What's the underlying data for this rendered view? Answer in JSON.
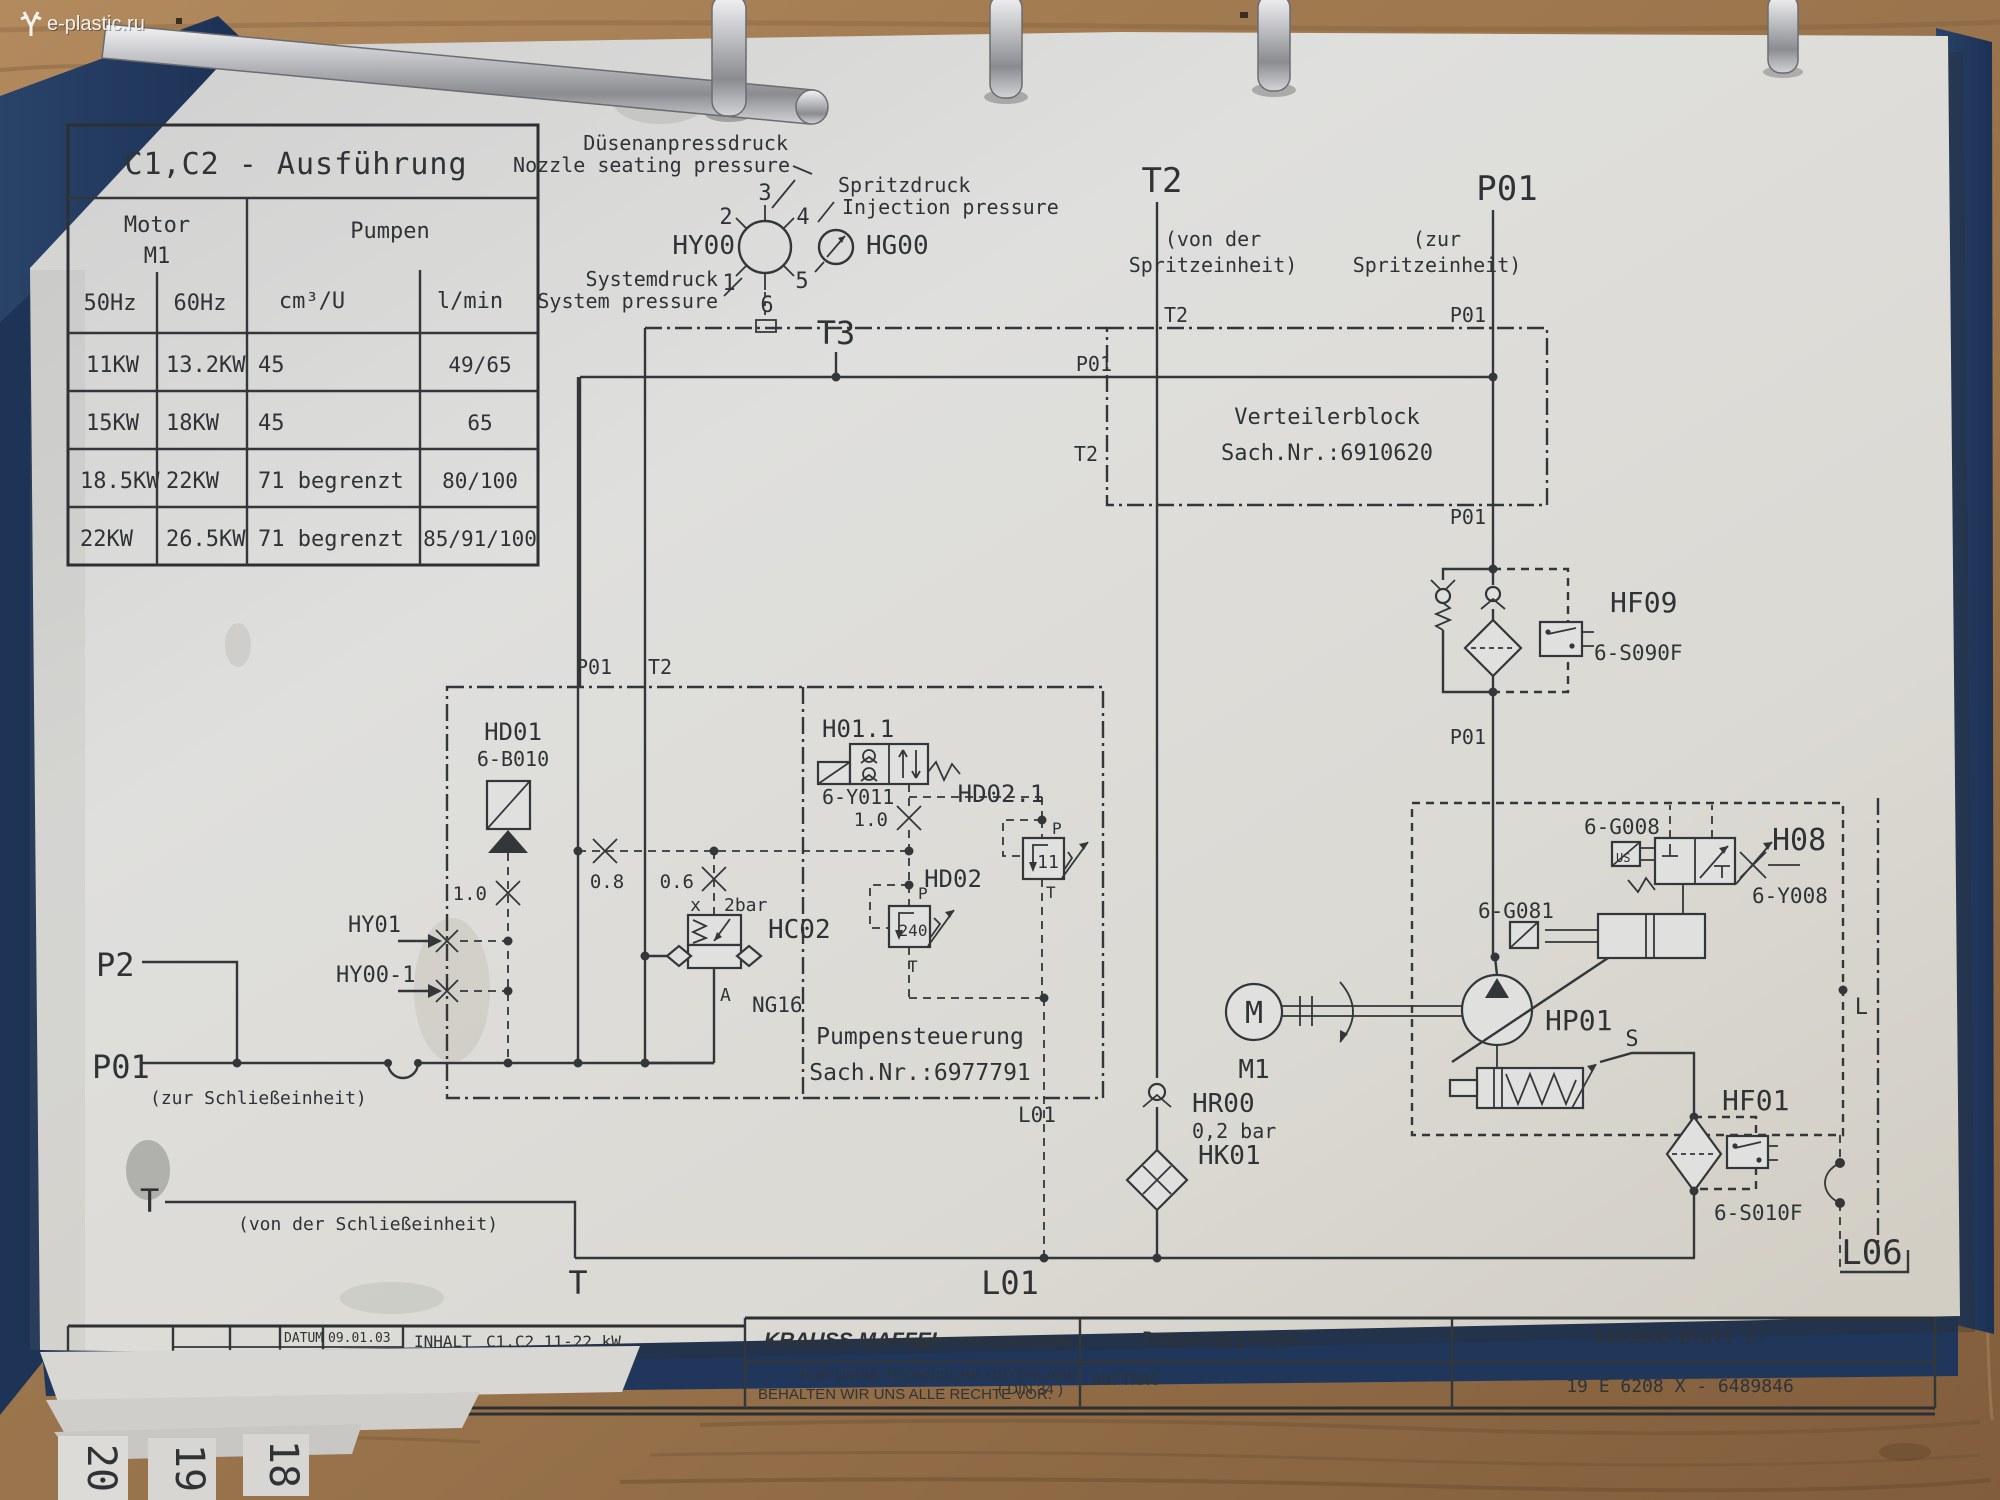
{
  "watermark": "e-plastic.ru",
  "spec_table": {
    "title": "C1,C2 - Ausführung",
    "motor": "Motor",
    "motor_sub": "M1",
    "pumpen": "Pumpen",
    "hz50": "50Hz",
    "hz60": "60Hz",
    "cm3u": "cm³/U",
    "lmin": "l/min",
    "rows": [
      {
        "kw50": "11KW",
        "kw60": "13.2KW",
        "cm3": "45",
        "lmin": "49/65"
      },
      {
        "kw50": "15KW",
        "kw60": "18KW",
        "cm3": "45",
        "lmin": "65"
      },
      {
        "kw50": "18.5KW",
        "kw60": "22KW",
        "cm3": "71 begrenzt",
        "lmin": "80/100"
      },
      {
        "kw50": "22KW",
        "kw60": "26.5KW",
        "cm3": "71 begrenzt",
        "lmin": "85/91/100"
      }
    ]
  },
  "gauge": {
    "duesen_de": "Düsenanpressdruck",
    "duesen_en": "Nozzle seating pressure",
    "spritz_de": "Spritzdruck",
    "spritz_en": "Injection pressure",
    "system_de": "Systemdruck",
    "system_en": "System pressure",
    "hy00": "HY00",
    "hg00": "HG00",
    "t3": "T3",
    "pos1": "1",
    "pos2": "2",
    "pos3": "3",
    "pos4": "4",
    "pos5": "5",
    "pos6": "6"
  },
  "ports": {
    "t2": "T2",
    "von_der": "(von der",
    "spritzeinheit": "Spritzeinheit)",
    "p01": "P01",
    "zur": "(zur",
    "t2_s1": "T2",
    "p01_s0": "P01",
    "p01_s1": "P01",
    "t2_s2": "T2",
    "p01_s2": "P01",
    "p01_s3": "P01",
    "box_p01": "P01",
    "box_t2": "T2",
    "p2": "P2",
    "p01_left": "P01",
    "zur_schliesseinheit": "(zur Schließeinheit)",
    "t_left": "T",
    "von_der_schliesseinheit": "(von der Schließeinheit)",
    "t_bottom": "T",
    "l01_big": "L01",
    "l01_small": "L01",
    "l06": "L06",
    "l": "L",
    "s": "S"
  },
  "verteilerblock": {
    "name": "Verteilerblock",
    "sachnr": "Sach.Nr.:6910620"
  },
  "pumpensteuerung": {
    "name": "Pumpensteuerung",
    "sachnr": "Sach.Nr.:6977791"
  },
  "components": {
    "hd01": "HD01",
    "hd01_code": "6-B010",
    "or_a": "1.0",
    "or_b": "0.8",
    "or_c": "0.6",
    "or_d": "1.0",
    "hy01": "HY01",
    "hy00_1": "HY00-1",
    "hc02": "HC02",
    "hc02_x": "x",
    "hc02_p": "2bar",
    "hc02_a": "A",
    "hc02_ng": "NG16",
    "h011": "H01.1",
    "h011_code": "6-Y011",
    "hd02_1": "HD02.1",
    "hd02_1_val": "11",
    "hd02": "HD02",
    "hd02_val": "240",
    "p_a": "P",
    "t_a": "T",
    "p_b": "P",
    "t_b": "T",
    "hf09": "HF09",
    "hf09_code": "6-S090F",
    "hf01": "HF01",
    "hf01_code": "6-S010F",
    "h08": "H08",
    "g008": "6-G008",
    "y008": "6-Y008",
    "g081": "6-G081",
    "us": "US",
    "hp01": "HP01",
    "m": "M",
    "m1": "M1",
    "hr00": "HR00",
    "hr00_val": "0,2 bar",
    "hk01": "HK01"
  },
  "titleblock": {
    "datum_label": "DATUM",
    "datum": "09.01.03",
    "bearb_label": "BEARB.",
    "bearb": "Hähnel",
    "gepr_label": "GEPR.",
    "gepr": "HV",
    "norm_label": "NORM",
    "aenderung": "AENDERUNG",
    "datum2": "DATUM",
    "name2": "NAME",
    "inhalt_label": "INHALT",
    "inhalt": "C1,C2 11-22 kW",
    "company_main": "KRAUSS MAFFEI",
    "company_rest": "KUNSTSTOFFTECHNIK GMBH",
    "rights1": "FÜR DIESE TECHNISCHE UNTERLAGE",
    "rights2": "BEHALTEN WIR UNS ALLE RECHTE VOR.",
    "din": "( DIN 34 )",
    "auftrag": "AUFTRAG",
    "project": "Pumpenaggregat",
    "doc_no1": "6489846-Blatt 2-",
    "doc_no2": "19 E 6208 X - 6489846"
  },
  "tabs": {
    "t20": "20",
    "t19": "19",
    "t18": "18"
  },
  "colors": {
    "binder": "#22395e",
    "paper": "#dedcd8",
    "ink": "#33373a",
    "wood": "#9a774f"
  }
}
